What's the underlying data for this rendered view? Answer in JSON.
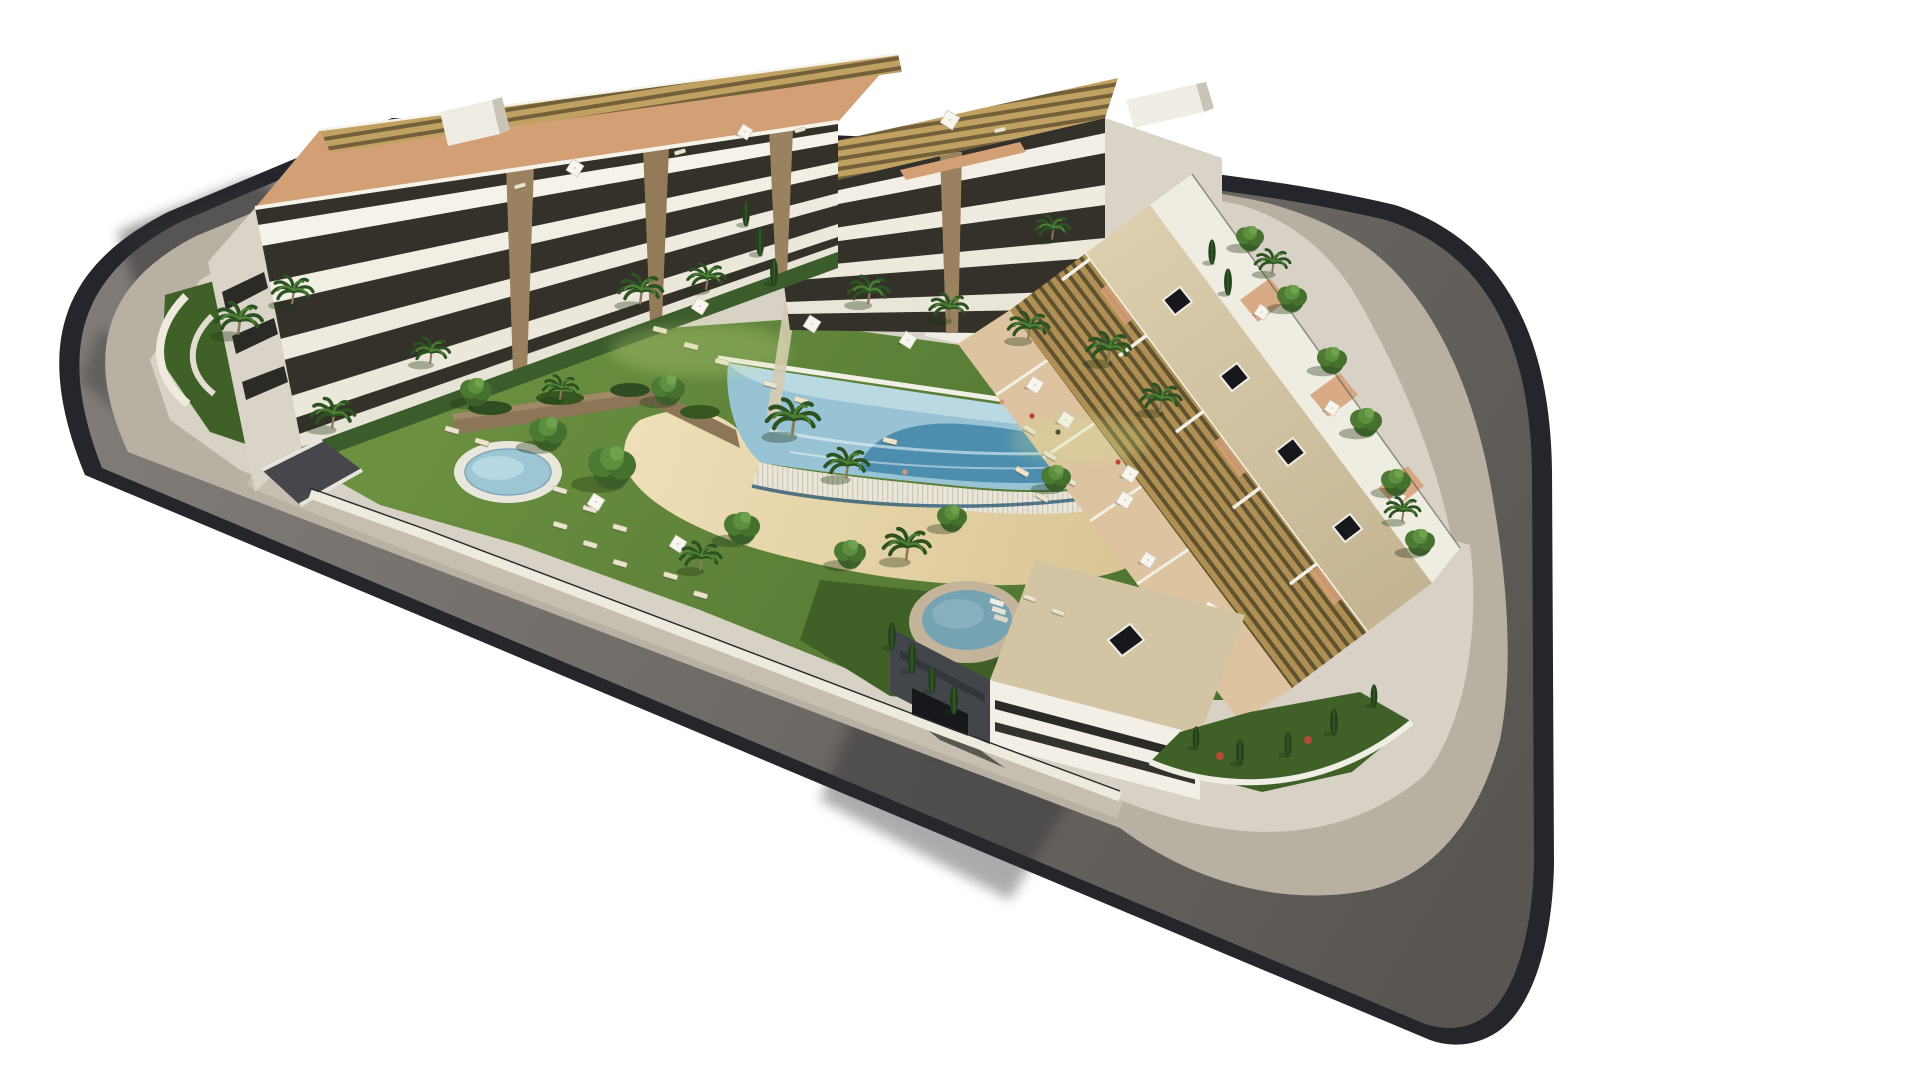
{
  "meta": {
    "background": "#ffffff",
    "description": "Aerial 3D architectural rendering of a white modern apartment complex on a rounded street block with a central lagoon pool, sandy beach entry, spa pool, kids pool, playground and landscaped gardens"
  },
  "palette": {
    "background": "#ffffff",
    "curb": "#24262c",
    "road": "#6e6a66",
    "sidewalk": "#b9b0a4",
    "walkway": "#c6beb1",
    "block_base": "#d8d2c6",
    "wall_white": "#f0ede4",
    "lawn": "#5d8438",
    "lawn_shade": "#3f6128",
    "sand": "#e7d6ac",
    "stone_wall": "#8d7557",
    "pool_base": "#97c3d4",
    "pool_deep": "#3f85a8",
    "pool_shallow": "#c6e0e8",
    "cascade": "#e9e5d8",
    "kids_pool": "#9cc6d4",
    "spa_water": "#76a3b2",
    "spa_ring": "#c3b49b",
    "playground": "#7d83c5",
    "playground_patch": "#9fb0dc",
    "pergola": "#b99a5c",
    "terracotta": "#d3a075",
    "roof_beige": "#d3c5a3",
    "skylight": "#17181c",
    "facade": "#f3efe6",
    "facade_shade": "#d9d4c7",
    "facade_dark": "#34302a",
    "dark_face": "#42454a",
    "tree": "#3c6129",
    "cypress": "#23421c",
    "lounger": "#ece3cc",
    "umbrella": "#f7f5ee",
    "shadow": "#2e2e33"
  },
  "scene": {
    "road": {
      "label": "ring-road"
    },
    "sidewalk": {
      "label": "perimeter-sidewalk"
    },
    "buildings": {
      "west": {
        "label": "west-apartment-block"
      },
      "north": {
        "label": "north-apartment-block"
      },
      "east": {
        "label": "east-terraced-row"
      },
      "south": {
        "label": "south-apartment-block"
      }
    },
    "amenities": {
      "lagoon_pool": {
        "label": "lagoon-pool"
      },
      "beach": {
        "label": "sand-beach-entry"
      },
      "kids_pool": {
        "label": "kids-pool"
      },
      "spa": {
        "label": "round-spa-pool"
      },
      "playground": {
        "label": "playground"
      },
      "pavilion": {
        "label": "pool-pavilion"
      }
    }
  }
}
